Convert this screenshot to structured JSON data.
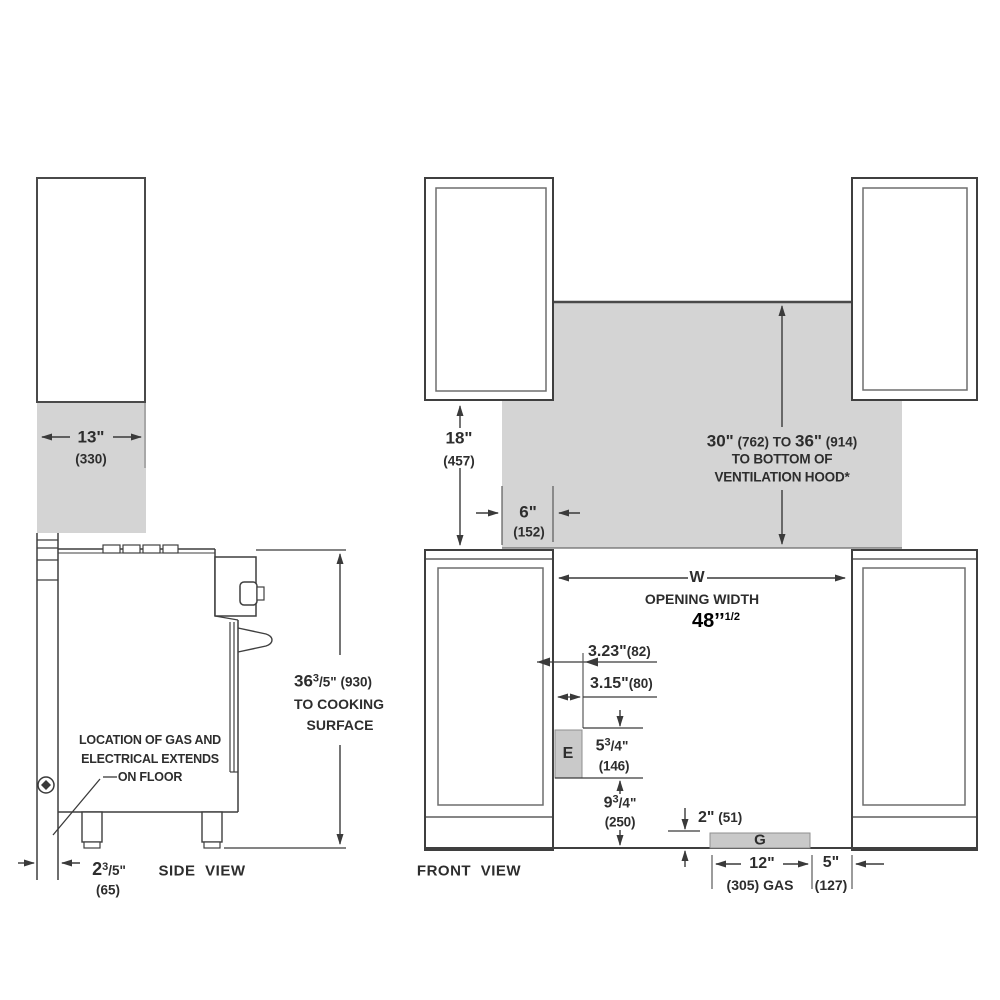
{
  "side_view": {
    "label": "SIDE VIEW",
    "cabinet_width": {
      "in": "13\"",
      "mm": "(330)"
    },
    "cooking_height": {
      "whole": "36",
      "num": "3",
      "den": "/5\"",
      "mm": "(930)",
      "line2": "TO COOKING",
      "line3": "SURFACE"
    },
    "floor_clearance": {
      "whole": "2",
      "num": "3",
      "den": "/5\"",
      "mm": "(65)"
    },
    "gas_note": {
      "line1": "LOCATION OF GAS AND",
      "line2": "ELECTRICAL EXTENDS",
      "line3": "ON FLOOR"
    }
  },
  "front_view": {
    "label": "FRONT VIEW",
    "counter_to_cabinet": {
      "in": "18\"",
      "mm": "(457)"
    },
    "backsplash_side": {
      "in": "6\"",
      "mm": "(152)"
    },
    "hood_clearance": {
      "v1": "30\"",
      "m1": " (762) TO ",
      "v2": "36\"",
      "m2": " (914)",
      "line2": "TO BOTTOM OF",
      "line3": "VENTILATION HOOD*"
    },
    "opening": {
      "letter": "W",
      "label": "OPENING WIDTH",
      "value": "48’’",
      "value_sup": "1/2"
    },
    "electrical_offset_a": {
      "in": "3.23\"",
      "mm": "(82)"
    },
    "electrical_offset_b": {
      "in": "3.15\"",
      "mm": "(80)"
    },
    "electrical_box": "E",
    "electrical_height": {
      "whole": "5",
      "num": "3",
      "den": "/4\"",
      "mm": "(146)"
    },
    "electrical_floor": {
      "whole": "9",
      "num": "3",
      "den": "/4\"",
      "mm": "(250)"
    },
    "gas_height": {
      "in": "2\"",
      "mm": "(51)"
    },
    "gas_box": "G",
    "gas_width": {
      "in": "12\"",
      "mm": "(305) GAS"
    },
    "gas_offset": {
      "in": "5\"",
      "mm": "(127)"
    }
  }
}
